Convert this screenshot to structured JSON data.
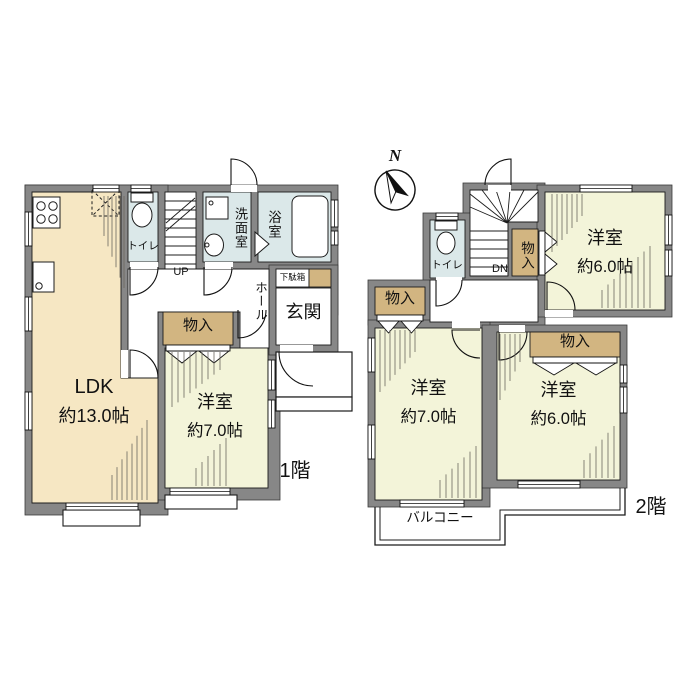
{
  "floor1": {
    "label": "1階",
    "ldk_name": "LDK",
    "ldk_size": "約13.0帖",
    "yoshitsu_name": "洋室",
    "yoshitsu_size": "約7.0帖",
    "toilet": "トイレ",
    "stairs_up": "UP",
    "washroom": "洗面室",
    "bathroom": "浴室",
    "hall": "ホール",
    "shoe_cabinet": "下駄箱",
    "entrance": "玄関",
    "closet": "物入"
  },
  "floor2": {
    "label": "2階",
    "compass_north": "N",
    "toilet": "トイレ",
    "stairs_down": "DN",
    "closet_by_stairs": "物入",
    "closet_west": "物入",
    "closet_south": "物入",
    "room_ne_name": "洋室",
    "room_ne_size": "約6.0帖",
    "room_sw_name": "洋室",
    "room_sw_size": "約7.0帖",
    "room_se_name": "洋室",
    "room_se_size": "約6.0帖",
    "balcony": "バルコニー"
  },
  "colors": {
    "wall": "#878787",
    "ldk_floor": "#f6e7c3",
    "western_room_floor": "#f3f4d9",
    "wet_area_floor": "#dbe8e9",
    "closet_fill": "#d2b581",
    "background": "#ffffff"
  }
}
